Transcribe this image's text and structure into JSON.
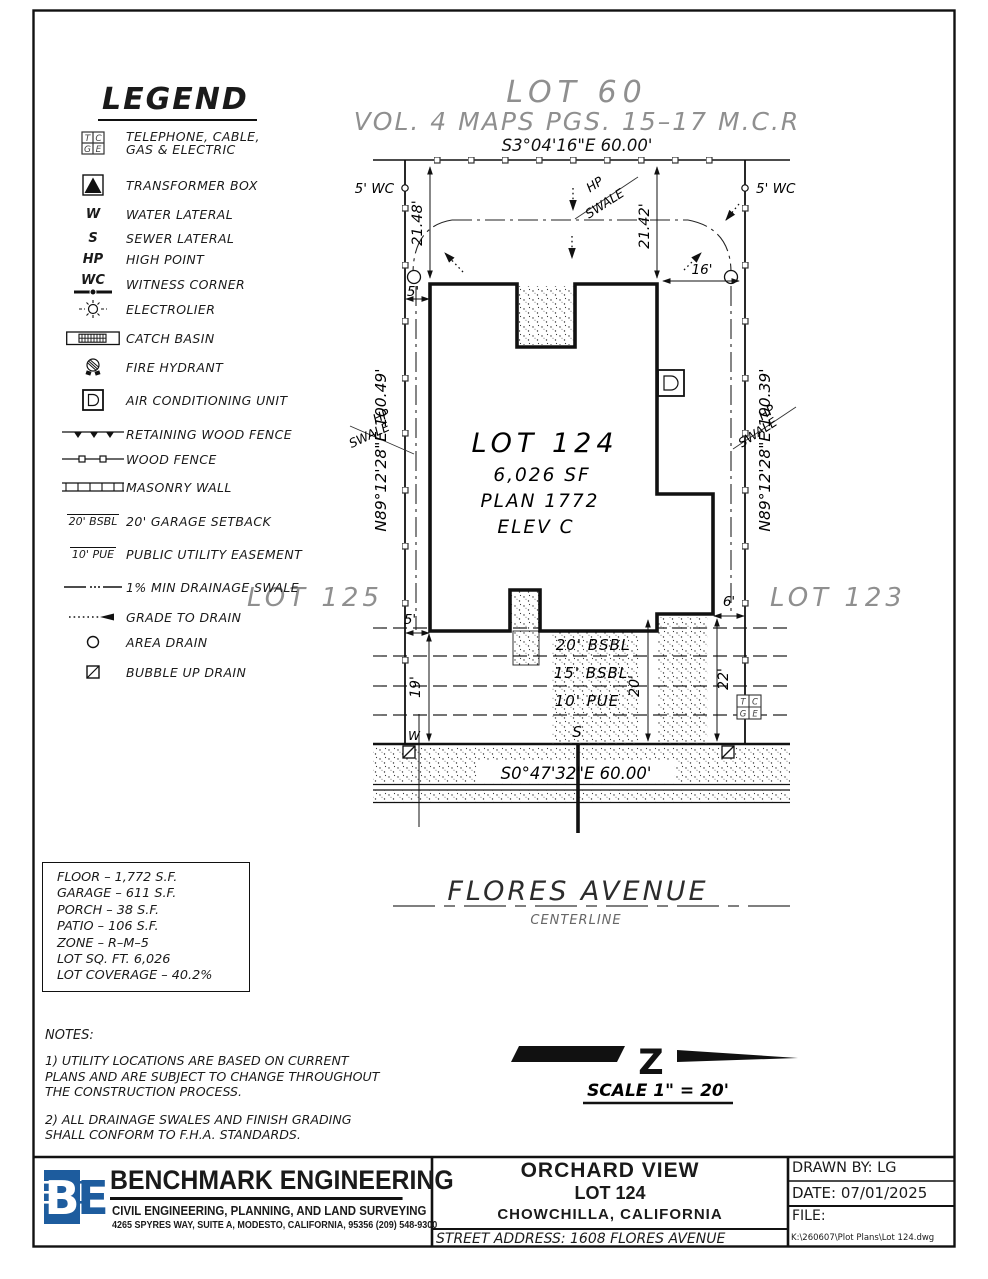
{
  "legend": {
    "title": "LEGEND",
    "sym_w": "W",
    "sym_s": "S",
    "sym_hp": "HP",
    "sym_wc": "WC",
    "sym_bsbl": "20' BSBL",
    "sym_pue": "10' PUE",
    "items": [
      {
        "label": "TELEPHONE, CABLE,",
        "label2": "GAS & ELECTRIC"
      },
      {
        "label": "TRANSFORMER BOX"
      },
      {
        "label": "WATER LATERAL"
      },
      {
        "label": "SEWER LATERAL"
      },
      {
        "label": "HIGH POINT"
      },
      {
        "label": "WITNESS CORNER"
      },
      {
        "label": "ELECTROLIER"
      },
      {
        "label": "CATCH BASIN"
      },
      {
        "label": "FIRE HYDRANT"
      },
      {
        "label": "AIR CONDITIONING UNIT"
      },
      {
        "label": "RETAINING WOOD FENCE"
      },
      {
        "label": "WOOD FENCE"
      },
      {
        "label": "MASONRY WALL"
      },
      {
        "label": "20' GARAGE SETBACK"
      },
      {
        "label": "PUBLIC UTILITY EASEMENT"
      },
      {
        "label": "1% MIN DRAINAGE SWALE"
      },
      {
        "label": "GRADE TO DRAIN"
      },
      {
        "label": "AREA DRAIN"
      },
      {
        "label": "BUBBLE UP DRAIN"
      }
    ]
  },
  "plot": {
    "lot60": "LOT 60",
    "vol": "VOL. 4 MAPS PGS. 15–17 M.C.R",
    "bearing_top": "S3°04'16\"E  60.00'",
    "bearing_bottom": "S0°47'32\"E  60.00'",
    "bearing_left": "N89°12'28\"E  100.49'",
    "bearing_right": "N89°12'28\"E  100.39'",
    "wc_left": "5'  WC",
    "wc_right": "5'  WC",
    "dim_2148": "21.48'",
    "dim_2142": "21.42'",
    "dim_16": "16'",
    "dim_5_top": "5'",
    "dim_5_bot": "5'",
    "dim_6": "6'",
    "dim_19": "19'",
    "dim_20": "20'",
    "dim_22": "22'",
    "hp_label": "HP",
    "swale_label": "SWALE",
    "lot124": "LOT 124",
    "sf": "6,026 SF",
    "plan": "PLAN 1772",
    "elev": "ELEV C",
    "lot125": "LOT 125",
    "lot123": "LOT 123",
    "bsbl20": "20' BSBL",
    "bsbl15": "15' BSBL",
    "pue10": "10' PUE",
    "w": "W",
    "s": "S",
    "tcge": {
      "t": "T",
      "c": "C",
      "g": "G",
      "e": "E"
    },
    "street": "FLORES AVENUE",
    "centerline": "CENTERLINE",
    "scale": "SCALE  1\" = 20'",
    "north": "Z"
  },
  "stats": {
    "lines": [
      "FLOOR – 1,772 S.F.",
      "GARAGE – 611 S.F.",
      "PORCH – 38 S.F.",
      "PATIO – 106 S.F.",
      "ZONE – R–M–5",
      "LOT SQ. FT. 6,026",
      "LOT COVERAGE – 40.2%"
    ]
  },
  "notes": {
    "title": "NOTES:",
    "n1": "1) UTILITY LOCATIONS ARE BASED ON CURRENT PLANS AND ARE SUBJECT TO CHANGE THROUGHOUT THE CONSTRUCTION PROCESS.",
    "n2": "2) ALL DRAINAGE SWALES AND FINISH GRADING SHALL CONFORM TO F.H.A. STANDARDS."
  },
  "title_block": {
    "logo_b": "B",
    "logo_e": "E",
    "company": "BENCHMARK ENGINEERING",
    "tagline": "CIVIL ENGINEERING, PLANNING, AND LAND SURVEYING",
    "address": "4265 SPYRES WAY, SUITE A, MODESTO, CALIFORNIA, 95356    (209) 548-9300",
    "project": "ORCHARD VIEW",
    "lot": "LOT 124",
    "city": "CHOWCHILLA,    CALIFORNIA",
    "street": "STREET    ADDRESS:  1608  FLORES  AVENUE",
    "drawn": "DRAWN  BY:  LG",
    "date": "DATE:   07/01/2025",
    "file": "FILE:",
    "path": "K:\\260607\\Plot Plans\\Lot 124.dwg"
  }
}
